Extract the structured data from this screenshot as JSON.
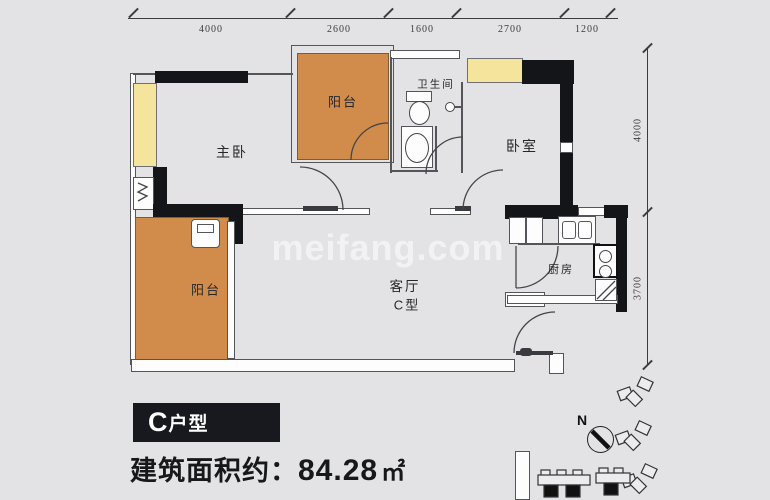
{
  "dimensions": {
    "top": [
      "4000",
      "2600",
      "1600",
      "2700",
      "1200"
    ],
    "right": [
      "4000",
      "3700"
    ]
  },
  "rooms": {
    "master_bedroom": "主卧",
    "balcony_top": "阳台",
    "bathroom": "卫生间",
    "bedroom": "卧室",
    "living_room": "客厅",
    "living_room_type": "C型",
    "kitchen": "厨房",
    "balcony_bottom": "阳台"
  },
  "watermark": "meifang.com",
  "compass": {
    "north": "N"
  },
  "footer": {
    "unit_letter": "C",
    "unit_suffix": "户型",
    "area_label": "建筑面积约：",
    "area_value": "84.28",
    "area_unit": "㎡"
  },
  "colors": {
    "background": "#e3e3e5",
    "balcony_fill": "#d18c4c",
    "window_fill": "#f4e49c",
    "wall_black": "#141518",
    "line": "#54555a",
    "label_box_bg": "#17191e",
    "footer_text": "#17181a"
  }
}
